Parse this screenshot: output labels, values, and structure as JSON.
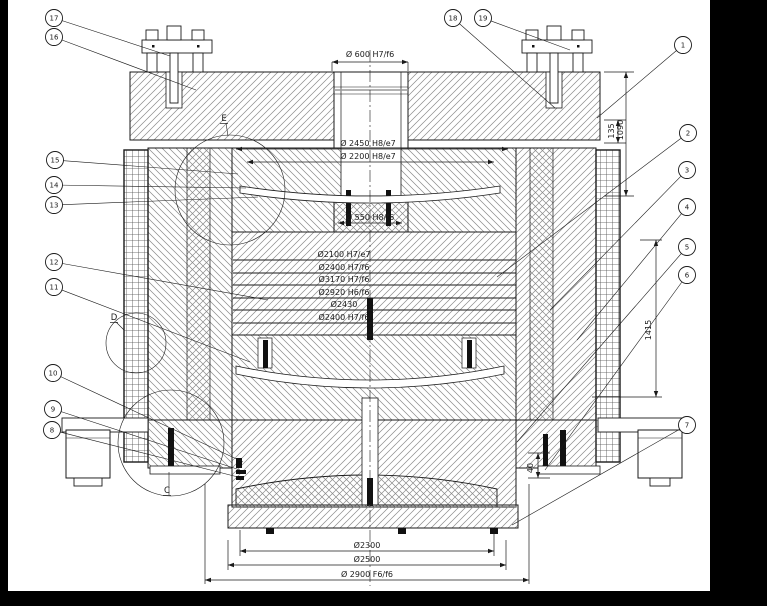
{
  "drawing": {
    "colors": {
      "line": "#1a1a1a",
      "hatch": "#777777",
      "paper": "#ffffff",
      "frame": "#000000"
    },
    "balloons": [
      {
        "n": "1",
        "cx": 683,
        "cy": 45,
        "tx": 597,
        "ty": 118
      },
      {
        "n": "2",
        "cx": 688,
        "cy": 133,
        "tx": 497,
        "ty": 277
      },
      {
        "n": "3",
        "cx": 687,
        "cy": 170,
        "tx": 550,
        "ty": 310
      },
      {
        "n": "4",
        "cx": 687,
        "cy": 207,
        "tx": 577,
        "ty": 340
      },
      {
        "n": "5",
        "cx": 687,
        "cy": 247,
        "tx": 517,
        "ty": 442
      },
      {
        "n": "6",
        "cx": 687,
        "cy": 275,
        "tx": 545,
        "ty": 470
      },
      {
        "n": "7",
        "cx": 687,
        "cy": 425,
        "tx": 512,
        "ty": 525
      },
      {
        "n": "8",
        "cx": 52,
        "cy": 430,
        "tx": 238,
        "ty": 477
      },
      {
        "n": "9",
        "cx": 53,
        "cy": 409,
        "tx": 240,
        "ty": 470
      },
      {
        "n": "10",
        "cx": 53,
        "cy": 373,
        "tx": 243,
        "ty": 462
      },
      {
        "n": "11",
        "cx": 54,
        "cy": 287,
        "tx": 250,
        "ty": 362
      },
      {
        "n": "12",
        "cx": 54,
        "cy": 262,
        "tx": 268,
        "ty": 300
      },
      {
        "n": "13",
        "cx": 54,
        "cy": 205,
        "tx": 258,
        "ty": 197
      },
      {
        "n": "14",
        "cx": 54,
        "cy": 185,
        "tx": 246,
        "ty": 188
      },
      {
        "n": "15",
        "cx": 55,
        "cy": 160,
        "tx": 238,
        "ty": 174
      },
      {
        "n": "16",
        "cx": 54,
        "cy": 37,
        "tx": 196,
        "ty": 90
      },
      {
        "n": "17",
        "cx": 54,
        "cy": 18,
        "tx": 170,
        "ty": 56
      },
      {
        "n": "18",
        "cx": 453,
        "cy": 18,
        "tx": 555,
        "ty": 108
      },
      {
        "n": "19",
        "cx": 483,
        "cy": 18,
        "tx": 570,
        "ty": 50
      }
    ],
    "dim_texts": [
      {
        "t": "Ø 600 H7/f6",
        "x": 370,
        "y": 57,
        "r": 0
      },
      {
        "t": "Ø 2450 H8/e7",
        "x": 368,
        "y": 146,
        "r": 0
      },
      {
        "t": "Ø 2200 H8/e7",
        "x": 368,
        "y": 159,
        "r": 0
      },
      {
        "t": "Ø 550 H8/f6",
        "x": 370,
        "y": 220,
        "r": 0
      },
      {
        "t": "Ø2100 H7/e7",
        "x": 344,
        "y": 257,
        "r": 0
      },
      {
        "t": "Ø2400 H7/f6",
        "x": 344,
        "y": 270,
        "r": 0
      },
      {
        "t": "Ø3170 H7/f6",
        "x": 344,
        "y": 282,
        "r": 0
      },
      {
        "t": "Ø2920 H6/f6",
        "x": 344,
        "y": 295,
        "r": 0
      },
      {
        "t": "Ø2430",
        "x": 344,
        "y": 307,
        "r": 0
      },
      {
        "t": "Ø2400 H7/f6",
        "x": 344,
        "y": 320,
        "r": 0
      },
      {
        "t": "Ø2300",
        "x": 367,
        "y": 548,
        "r": 0
      },
      {
        "t": "Ø2500",
        "x": 367,
        "y": 562,
        "r": 0
      },
      {
        "t": "Ø 2900 F6/f6",
        "x": 367,
        "y": 577,
        "r": 0
      },
      {
        "t": "1090",
        "x": 623,
        "y": 130,
        "r": -90
      },
      {
        "t": "135",
        "x": 614,
        "y": 131,
        "r": -90
      },
      {
        "t": "1415",
        "x": 651,
        "y": 330,
        "r": -90
      },
      {
        "t": "40",
        "x": 533,
        "y": 468,
        "r": -90
      }
    ],
    "dim_lines": [
      [
        332,
        62,
        408,
        62,
        1
      ],
      [
        236,
        149,
        508,
        149,
        1
      ],
      [
        247,
        162,
        494,
        162,
        1
      ],
      [
        338,
        223,
        402,
        223,
        1
      ],
      [
        240,
        551,
        494,
        551,
        1
      ],
      [
        228,
        565,
        506,
        565,
        1
      ],
      [
        205,
        580,
        529,
        580,
        1
      ],
      [
        626,
        72,
        626,
        196,
        1
      ],
      [
        618,
        120,
        618,
        143,
        1
      ],
      [
        656,
        240,
        656,
        397,
        1
      ],
      [
        538,
        453,
        538,
        478,
        1
      ],
      [
        332,
        62,
        332,
        71,
        0
      ],
      [
        408,
        62,
        408,
        71,
        0
      ],
      [
        604,
        72,
        634,
        72,
        0
      ],
      [
        604,
        196,
        634,
        196,
        0
      ],
      [
        604,
        120,
        626,
        120,
        0
      ],
      [
        604,
        143,
        626,
        143,
        0
      ],
      [
        592,
        397,
        662,
        397,
        0
      ],
      [
        640,
        240,
        662,
        240,
        0
      ],
      [
        240,
        530,
        240,
        556,
        0
      ],
      [
        494,
        530,
        494,
        556,
        0
      ],
      [
        228,
        540,
        228,
        570,
        0
      ],
      [
        506,
        540,
        506,
        570,
        0
      ],
      [
        205,
        484,
        205,
        584,
        0
      ],
      [
        529,
        484,
        529,
        584,
        0
      ],
      [
        528,
        453,
        550,
        453,
        0
      ],
      [
        528,
        478,
        550,
        478,
        0
      ]
    ],
    "ring_lines": {
      "x1": 233,
      "x2": 516,
      "ys": [
        260,
        273,
        285,
        298,
        310,
        323,
        335
      ]
    },
    "centerline": [
      370,
      50,
      370,
      586
    ],
    "detail_letters": [
      {
        "label": "E",
        "x": 224,
        "y": 121,
        "cx": 230,
        "cy": 190,
        "r": 55,
        "lx": 228,
        "ly": 136
      },
      {
        "label": "D",
        "x": 114,
        "y": 320,
        "cx": 136,
        "cy": 343,
        "r": 30,
        "lx": 124,
        "ly": 330
      },
      {
        "label": "C",
        "x": 167,
        "y": 493,
        "cx": 171,
        "cy": 443,
        "r": 53,
        "lx": 169,
        "ly": 472
      }
    ]
  }
}
